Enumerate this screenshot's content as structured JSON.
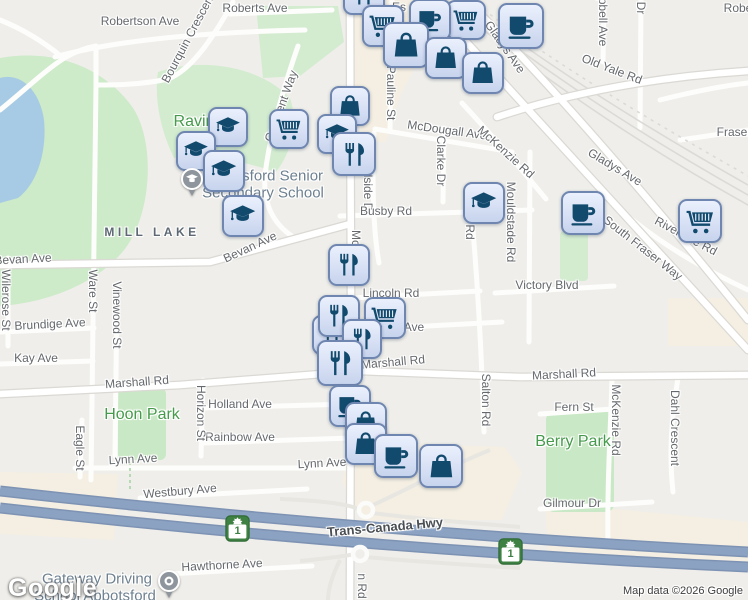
{
  "map": {
    "attribution": "Map data ©2026 Google",
    "google_logo": "Google",
    "colors": {
      "land": "#efeeea",
      "water": "#a7cbe4",
      "park": "#cdeac9",
      "commercial": "#f4efe2",
      "road": "#fdfdfc",
      "highway": "#8ba2c3",
      "marker_fill": "#d6dff4",
      "marker_border": "#6f86b0",
      "marker_icon": "#114a6d",
      "shield_green": "#3f8143",
      "park_label": "#459a4b",
      "street_label": "#65696d"
    },
    "labels": [
      {
        "kind": "street",
        "text": "Robertson Ave",
        "x": 140,
        "y": 21,
        "rotate": 0
      },
      {
        "kind": "street",
        "text": "Roberts Ave",
        "x": 255,
        "y": 8,
        "rotate": 0
      },
      {
        "kind": "street",
        "text": "Robe",
        "x": 738,
        "y": 8,
        "rotate": 0
      },
      {
        "kind": "street",
        "text": "Es",
        "x": 399,
        "y": 7,
        "rotate": 0
      },
      {
        "kind": "street",
        "text": "Bourquin Crescent",
        "x": 188,
        "y": 38,
        "rotate": -62
      },
      {
        "kind": "street",
        "text": "Crescent Way",
        "x": 281,
        "y": 106,
        "rotate": -70
      },
      {
        "kind": "street",
        "text": "Pauline St",
        "x": 391,
        "y": 93,
        "rotate": 90
      },
      {
        "kind": "street",
        "text": "Way",
        "x": 429,
        "y": 65,
        "rotate": 48
      },
      {
        "kind": "street",
        "text": "Gladys Ave",
        "x": 505,
        "y": 47,
        "rotate": 55
      },
      {
        "kind": "street",
        "text": "pbell Ave",
        "x": 603,
        "y": 22,
        "rotate": 90
      },
      {
        "kind": "street",
        "text": "Dr",
        "x": 641,
        "y": 8,
        "rotate": 90
      },
      {
        "kind": "street",
        "text": "Old Yale Rd",
        "x": 612,
        "y": 69,
        "rotate": 21
      },
      {
        "kind": "street",
        "text": "Fraser",
        "x": 734,
        "y": 132,
        "rotate": 0
      },
      {
        "kind": "street",
        "text": "McDougall Ave",
        "x": 447,
        "y": 130,
        "rotate": 8
      },
      {
        "kind": "street",
        "text": "McKenzie Rd",
        "x": 506,
        "y": 152,
        "rotate": 42
      },
      {
        "kind": "street",
        "text": "Gladys Ave",
        "x": 615,
        "y": 167,
        "rotate": 31
      },
      {
        "kind": "street",
        "text": "Hillside Dr",
        "x": 368,
        "y": 188,
        "rotate": 90
      },
      {
        "kind": "street",
        "text": "Clarke Dr",
        "x": 441,
        "y": 161,
        "rotate": 90
      },
      {
        "kind": "street",
        "text": "Busby Rd",
        "x": 386,
        "y": 211,
        "rotate": 0
      },
      {
        "kind": "street",
        "text": "Mouldstade Rd",
        "x": 511,
        "y": 222,
        "rotate": 90
      },
      {
        "kind": "street",
        "text": "n Rd",
        "x": 470,
        "y": 227,
        "rotate": 90
      },
      {
        "kind": "street",
        "text": "South Fraser Way",
        "x": 643,
        "y": 248,
        "rotate": 38
      },
      {
        "kind": "street",
        "text": "Riverside Rd",
        "x": 686,
        "y": 236,
        "rotate": 28
      },
      {
        "kind": "street",
        "text": "Victory Blvd",
        "x": 547,
        "y": 285,
        "rotate": 0
      },
      {
        "kind": "street",
        "text": "Bevan Ave",
        "x": 23,
        "y": 259,
        "rotate": -3
      },
      {
        "kind": "street",
        "text": "Bevan Ave",
        "x": 250,
        "y": 247,
        "rotate": -25
      },
      {
        "kind": "street",
        "text": "Mc",
        "x": 356,
        "y": 238,
        "rotate": 90
      },
      {
        "kind": "street",
        "text": "Lincoln Rd",
        "x": 391,
        "y": 293,
        "rotate": 0
      },
      {
        "kind": "street",
        "text": "Ave",
        "x": 414,
        "y": 327,
        "rotate": 0
      },
      {
        "kind": "street",
        "text": "Brundige Ave",
        "x": 50,
        "y": 324,
        "rotate": -3
      },
      {
        "kind": "street",
        "text": "Kay Ave",
        "x": 36,
        "y": 358,
        "rotate": 0
      },
      {
        "kind": "street",
        "text": "Wilerose St",
        "x": 6,
        "y": 300,
        "rotate": 90
      },
      {
        "kind": "street",
        "text": "Ware St",
        "x": 93,
        "y": 291,
        "rotate": 90
      },
      {
        "kind": "street",
        "text": "Vinewood St",
        "x": 117,
        "y": 315,
        "rotate": 90
      },
      {
        "kind": "street",
        "text": "Marshall Rd",
        "x": 137,
        "y": 382,
        "rotate": -4
      },
      {
        "kind": "street",
        "text": "Marshall Rd",
        "x": 393,
        "y": 362,
        "rotate": -5
      },
      {
        "kind": "street",
        "text": "Marshall Rd",
        "x": 564,
        "y": 374,
        "rotate": -3
      },
      {
        "kind": "street",
        "text": "Holland Ave",
        "x": 240,
        "y": 404,
        "rotate": 0
      },
      {
        "kind": "street",
        "text": "Rainbow Ave",
        "x": 240,
        "y": 437,
        "rotate": 0
      },
      {
        "kind": "street",
        "text": "Horizon St",
        "x": 201,
        "y": 413,
        "rotate": 90
      },
      {
        "kind": "street",
        "text": "Eagle St",
        "x": 80,
        "y": 448,
        "rotate": 90
      },
      {
        "kind": "street",
        "text": "Salton Rd",
        "x": 486,
        "y": 400,
        "rotate": 90
      },
      {
        "kind": "street",
        "text": "Fern St",
        "x": 574,
        "y": 407,
        "rotate": 0
      },
      {
        "kind": "street",
        "text": "McKenzie Rd",
        "x": 616,
        "y": 420,
        "rotate": 90
      },
      {
        "kind": "street",
        "text": "Dahl Crescent",
        "x": 675,
        "y": 428,
        "rotate": 90
      },
      {
        "kind": "street",
        "text": "Lynn Ave",
        "x": 133,
        "y": 459,
        "rotate": -3
      },
      {
        "kind": "street",
        "text": "Lynn Ave",
        "x": 322,
        "y": 463,
        "rotate": -3
      },
      {
        "kind": "street",
        "text": "Westbury Ave",
        "x": 180,
        "y": 491,
        "rotate": -5
      },
      {
        "kind": "street",
        "text": "Gilmour Dr",
        "x": 572,
        "y": 503,
        "rotate": 0
      },
      {
        "kind": "hwy",
        "text": "Trans-Canada Hwy",
        "x": 385,
        "y": 527,
        "rotate": -5
      },
      {
        "kind": "street",
        "text": "Hawthorne Ave",
        "x": 222,
        "y": 565,
        "rotate": -3
      },
      {
        "kind": "street",
        "text": "n Rd",
        "x": 362,
        "y": 586,
        "rotate": 90
      },
      {
        "kind": "hood",
        "text": "MILL LAKE",
        "x": 152,
        "y": 232,
        "rotate": 0
      },
      {
        "kind": "park",
        "text": "Ravin",
        "x": 194,
        "y": 122,
        "rotate": 0
      },
      {
        "kind": "park",
        "text": "Hoon Park",
        "x": 142,
        "y": 415,
        "rotate": 0
      },
      {
        "kind": "park",
        "text": "Berry Park",
        "x": 573,
        "y": 442,
        "rotate": 0
      },
      {
        "kind": "poi",
        "text": "Abbotsford Senior",
        "x": 263,
        "y": 176,
        "rotate": 0
      },
      {
        "kind": "poi",
        "text": "Secondary School",
        "x": 263,
        "y": 193,
        "rotate": 0
      },
      {
        "kind": "poi",
        "text": "Gateway Driving",
        "x": 97,
        "y": 579,
        "rotate": 0
      },
      {
        "kind": "poi",
        "text": "School Abbotsford",
        "x": 95,
        "y": 596,
        "rotate": 0
      }
    ],
    "markers": [
      {
        "type": "restaurant",
        "x": 364,
        "y": -6,
        "size": 42
      },
      {
        "type": "cart",
        "x": 383,
        "y": 26,
        "size": 42
      },
      {
        "type": "cart",
        "x": 466,
        "y": 20,
        "size": 40
      },
      {
        "type": "coffee",
        "x": 430,
        "y": 20,
        "size": 42
      },
      {
        "type": "bag",
        "x": 406,
        "y": 45,
        "size": 46
      },
      {
        "type": "bag",
        "x": 446,
        "y": 58,
        "size": 42
      },
      {
        "type": "bag",
        "x": 483,
        "y": 73,
        "size": 42
      },
      {
        "type": "coffee",
        "x": 521,
        "y": 26,
        "size": 46
      },
      {
        "type": "cart",
        "x": 289,
        "y": 129,
        "size": 40
      },
      {
        "type": "bag",
        "x": 350,
        "y": 106,
        "size": 40
      },
      {
        "type": "cap",
        "x": 337,
        "y": 134,
        "size": 40
      },
      {
        "type": "restaurant",
        "x": 354,
        "y": 154,
        "size": 44
      },
      {
        "type": "cap",
        "x": 228,
        "y": 127,
        "size": 40
      },
      {
        "type": "cap",
        "x": 196,
        "y": 151,
        "size": 40
      },
      {
        "type": "cap",
        "x": 224,
        "y": 171,
        "size": 42
      },
      {
        "type": "cap",
        "x": 243,
        "y": 216,
        "size": 42
      },
      {
        "type": "pin-school",
        "x": 192,
        "y": 182
      },
      {
        "type": "restaurant",
        "x": 349,
        "y": 265,
        "size": 42
      },
      {
        "type": "cap",
        "x": 484,
        "y": 203,
        "size": 42
      },
      {
        "type": "coffee",
        "x": 583,
        "y": 213,
        "size": 44
      },
      {
        "type": "cart",
        "x": 700,
        "y": 221,
        "size": 44
      },
      {
        "type": "restaurant",
        "x": 332,
        "y": 335,
        "size": 40
      },
      {
        "type": "restaurant",
        "x": 339,
        "y": 316,
        "size": 42
      },
      {
        "type": "cart",
        "x": 385,
        "y": 318,
        "size": 42
      },
      {
        "type": "restaurant",
        "x": 362,
        "y": 339,
        "size": 40
      },
      {
        "type": "restaurant",
        "x": 340,
        "y": 363,
        "size": 46
      },
      {
        "type": "cafe",
        "x": 350,
        "y": 406,
        "size": 42
      },
      {
        "type": "bag",
        "x": 366,
        "y": 423,
        "size": 42
      },
      {
        "type": "bag",
        "x": 366,
        "y": 444,
        "size": 42
      },
      {
        "type": "coffee",
        "x": 396,
        "y": 456,
        "size": 44
      },
      {
        "type": "bag",
        "x": 441,
        "y": 466,
        "size": 44
      },
      {
        "type": "pin-generic",
        "x": 169,
        "y": 584
      }
    ],
    "shields": [
      {
        "label": "1",
        "x": 237,
        "y": 528
      },
      {
        "label": "1",
        "x": 510,
        "y": 551
      }
    ]
  }
}
